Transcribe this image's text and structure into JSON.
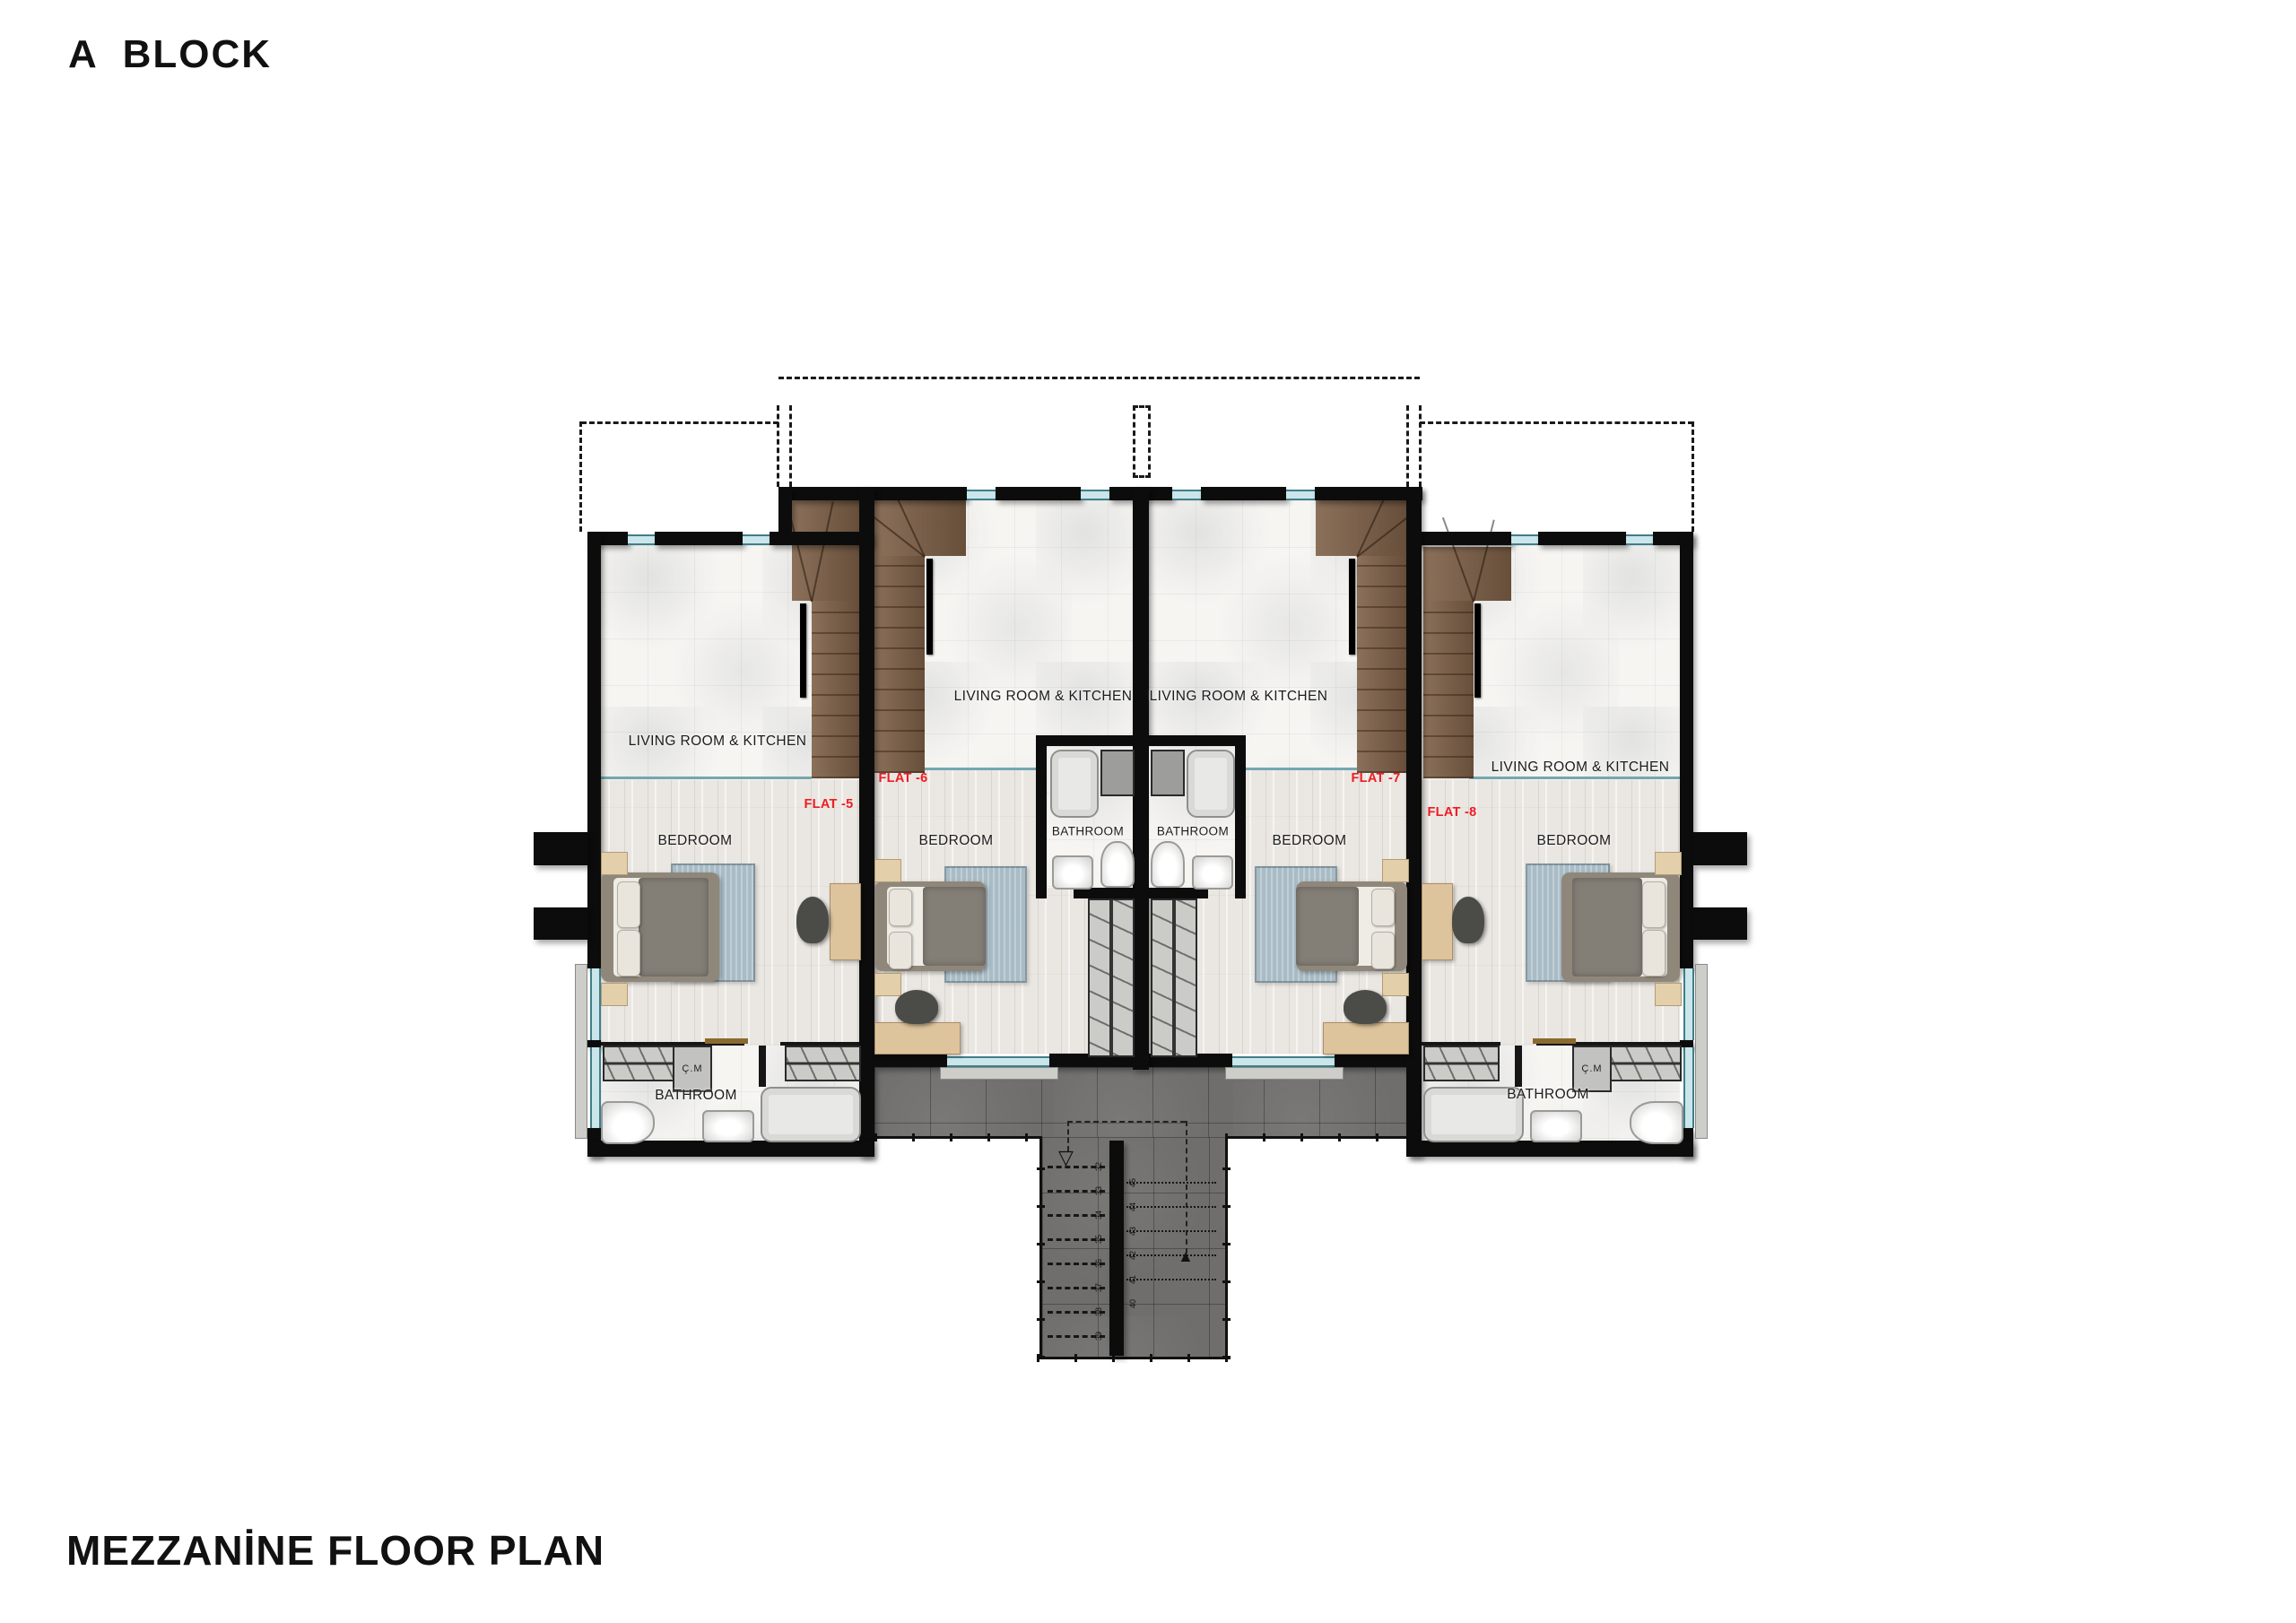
{
  "titles": {
    "block": "A  BLOCK",
    "plan": "MEZZANİNE FLOOR PLAN"
  },
  "rooms": {
    "living": "LIVING ROOM & KITCHEN",
    "bedroom": "BEDROOM",
    "bathroom": "BATHROOM",
    "washer": "Ç.M"
  },
  "flats": [
    {
      "name": "FLAT -5"
    },
    {
      "name": "FLAT -6"
    },
    {
      "name": "FLAT -7"
    },
    {
      "name": "FLAT -8"
    }
  ],
  "stairs": {
    "down_steps": [
      "32",
      "33",
      "34",
      "35",
      "36",
      "37",
      "38",
      "39"
    ],
    "up_steps": [
      "40",
      "41",
      "42",
      "43",
      "44",
      "45"
    ]
  },
  "icons": {
    "route_start_arrow": "▽",
    "route_end_arrow": "▲"
  },
  "colors": {
    "accent_red": "#ed1c24",
    "window_teal": "#407e8a",
    "stair_wood": "#7e6047",
    "terrace_stone": "#6f6e6c",
    "wall_black": "#0c0c0c"
  }
}
